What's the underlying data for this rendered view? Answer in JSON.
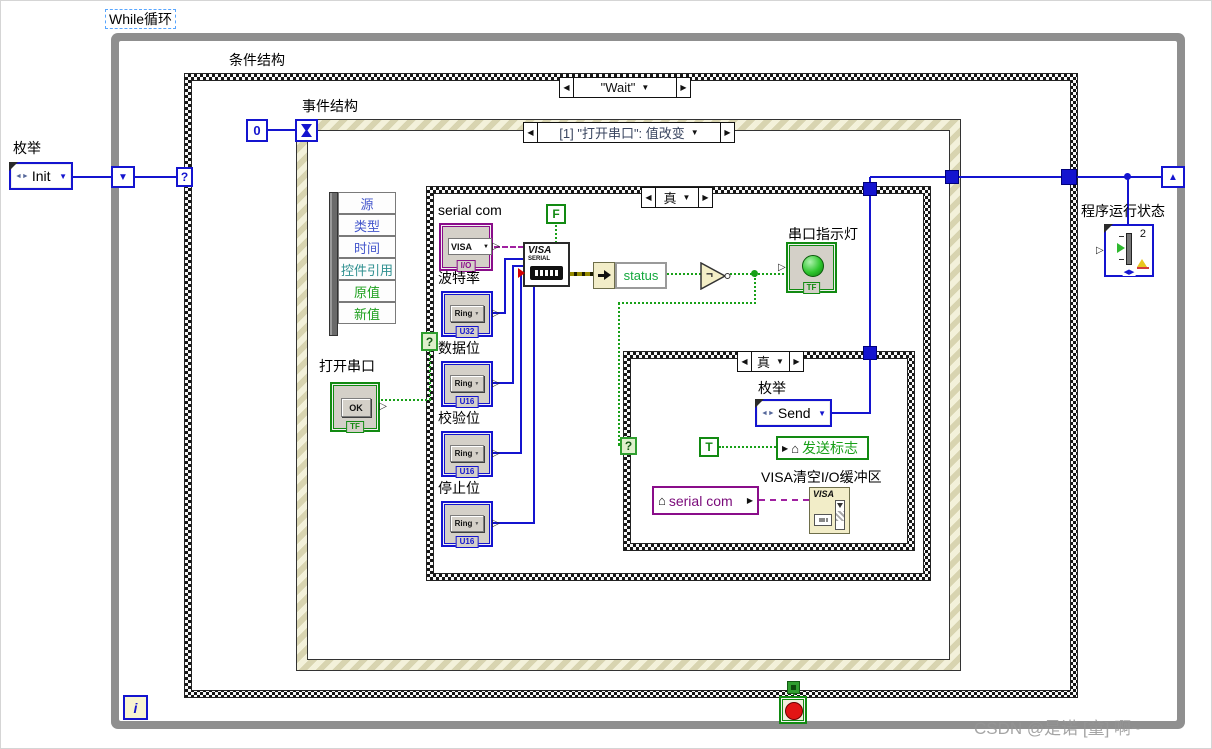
{
  "watermark": "CSDN @是诺 [童] 啊~",
  "icons": {
    "tri_left": "◀",
    "tri_right": "▶",
    "tri_down": "▼",
    "tri_up": "▲",
    "out_arrow": "▷",
    "home": "⌂",
    "enum_glyph": "◄►",
    "not_sign": "¬",
    "question_mark": "?",
    "iteration": "i",
    "dropdown": "▼"
  },
  "while_loop": {
    "label": "While循环"
  },
  "case_structure": {
    "label": "条件结构",
    "selector": "\"Wait\""
  },
  "event_structure": {
    "label": "事件结构",
    "selector": "[1] \"打开串口\": 值改变",
    "timeout_constant": "0"
  },
  "init_enum": {
    "label": "枚举",
    "value": "Init"
  },
  "event_data_node": {
    "items": [
      "源",
      "类型",
      "时间",
      "控件引用",
      "原值",
      "新值"
    ]
  },
  "open_serial_button": {
    "label": "打开串口",
    "button_text": "OK",
    "type_tag": "TF"
  },
  "true_case_outer": {
    "selector": "真"
  },
  "serial_com_control": {
    "label": "serial com",
    "text": "VISA",
    "type_tag": "I/O"
  },
  "false_constant": {
    "text": "F"
  },
  "visa_configure_node": {
    "title": "VISA",
    "subtitle": "SERIAL"
  },
  "ring_controls": [
    {
      "label": "波特率",
      "text": "Ring",
      "type_tag": "U32"
    },
    {
      "label": "数据位",
      "text": "Ring",
      "type_tag": "U16"
    },
    {
      "label": "校验位",
      "text": "Ring",
      "type_tag": "U16"
    },
    {
      "label": "停止位",
      "text": "Ring",
      "type_tag": "U16"
    }
  ],
  "status_unbundle": {
    "field": "status"
  },
  "serial_led": {
    "label": "串口指示灯",
    "type_tag": "TF"
  },
  "true_case_inner": {
    "selector": "真"
  },
  "send_enum": {
    "label": "枚举",
    "value": "Send"
  },
  "true_constant": {
    "text": "T"
  },
  "send_flag_local": {
    "label": "发送标志"
  },
  "serial_com_local": {
    "label": "serial com"
  },
  "visa_clear_node": {
    "label": "VISA清空I/O缓冲区",
    "title": "VISA"
  },
  "run_state_indicator": {
    "label": "程序运行状态",
    "value": "2"
  },
  "colors": {
    "wire_blue": "#1414cf",
    "wire_green": "#18a018",
    "wire_purple": "#a020a0",
    "wire_error": "#958a00",
    "loop_gray": "#8f8f8f",
    "event_border": "#d8d4b0",
    "green_terminal": "#128a12",
    "purple_terminal": "#8a0d8a"
  }
}
